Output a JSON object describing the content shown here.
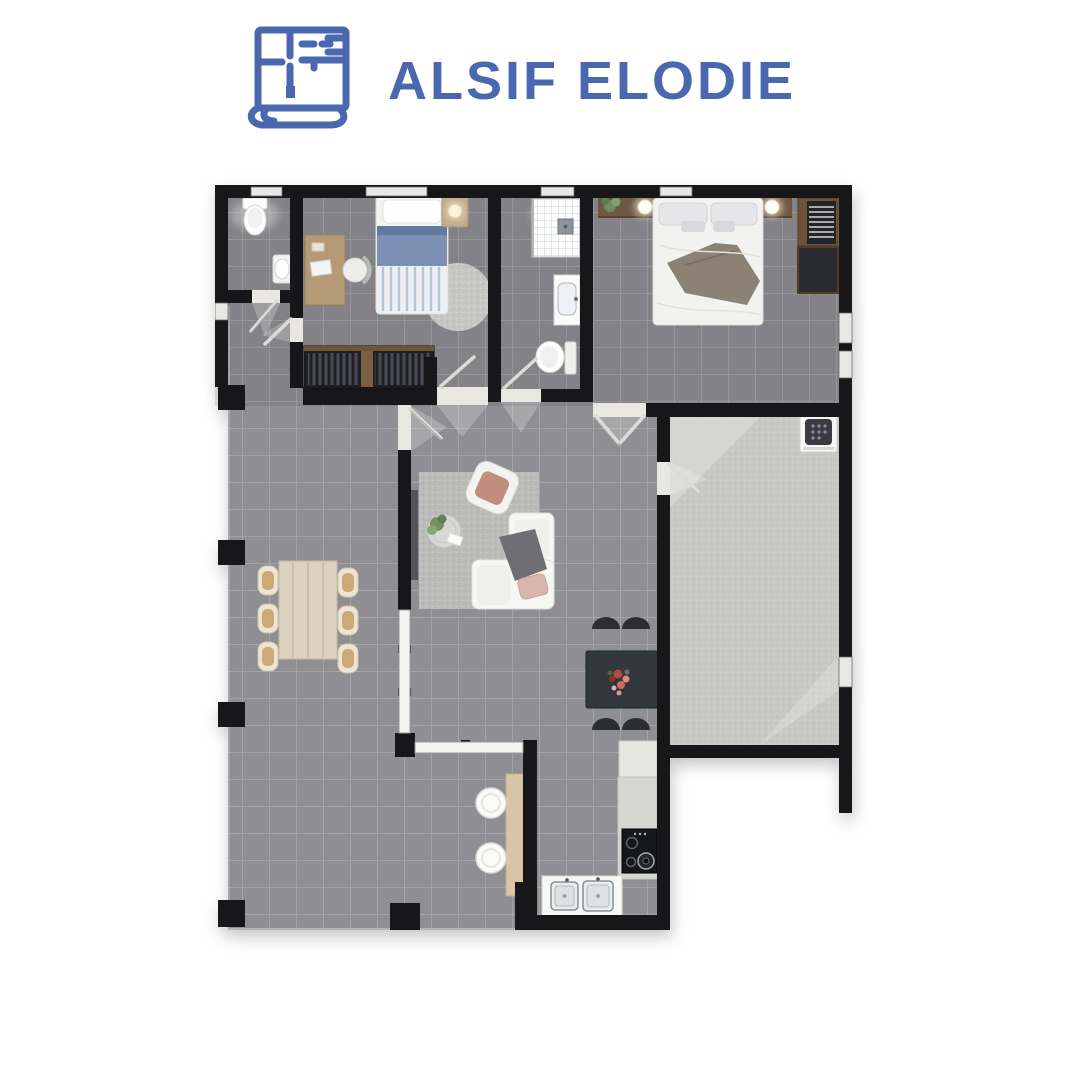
{
  "header": {
    "brand_name": "ALSIF ELODIE",
    "logo_icon": "blueprint-scroll-icon"
  },
  "colors": {
    "brand_blue": "#4a68b0",
    "wall": "#17171a",
    "floor_tile": "#8f8f93",
    "floor_grout": "#a9a9ad",
    "rooms_shade": "rgba(25,25,32,0.10)",
    "garage_floor": "#c8c8c6",
    "rug_gray": "#bbbbb9",
    "wood_light": "#dcd2bf",
    "wood_tan": "#c9a36d",
    "wood_dark": "#6e5843",
    "bar_wood": "#d8c5a6",
    "bed_blue": "#7b90b2",
    "bed_blue_dark": "#62799f",
    "throw_taupe": "#8b8174",
    "sofa_throw_gray": "#6e6e73",
    "accent_salmon": "#c28d7c",
    "accent_blush": "#d9b6ab",
    "dark_furniture": "#32373d",
    "fixture_white": "#fdfdfc",
    "counter_gray": "#d6d6d3",
    "stove_black": "#15171b",
    "fruit_red": "#b84a40",
    "plant_green": "#76905f"
  },
  "floor_plan": {
    "rooms": [
      "wc",
      "bedroom",
      "bathroom",
      "master-bedroom",
      "garage",
      "living-room",
      "kitchen",
      "dining-area",
      "hallway"
    ],
    "furniture": [
      "toilet",
      "hand-basin",
      "single-bed",
      "desk",
      "desk-chair",
      "round-rug",
      "wardrobe",
      "shower",
      "vanity-sink",
      "double-bed",
      "headboard-shelf",
      "bedside-lamp",
      "closet",
      "washing-machine",
      "dining-table",
      "dining-chairs",
      "sofa",
      "armchair",
      "coffee-table",
      "tv-panel",
      "area-rug",
      "kitchen-table",
      "kitchen-chairs",
      "fruit-bowl",
      "breakfast-bar",
      "bar-stools",
      "kitchen-counter",
      "stove",
      "double-sink",
      "pillars",
      "windows",
      "doors"
    ]
  }
}
